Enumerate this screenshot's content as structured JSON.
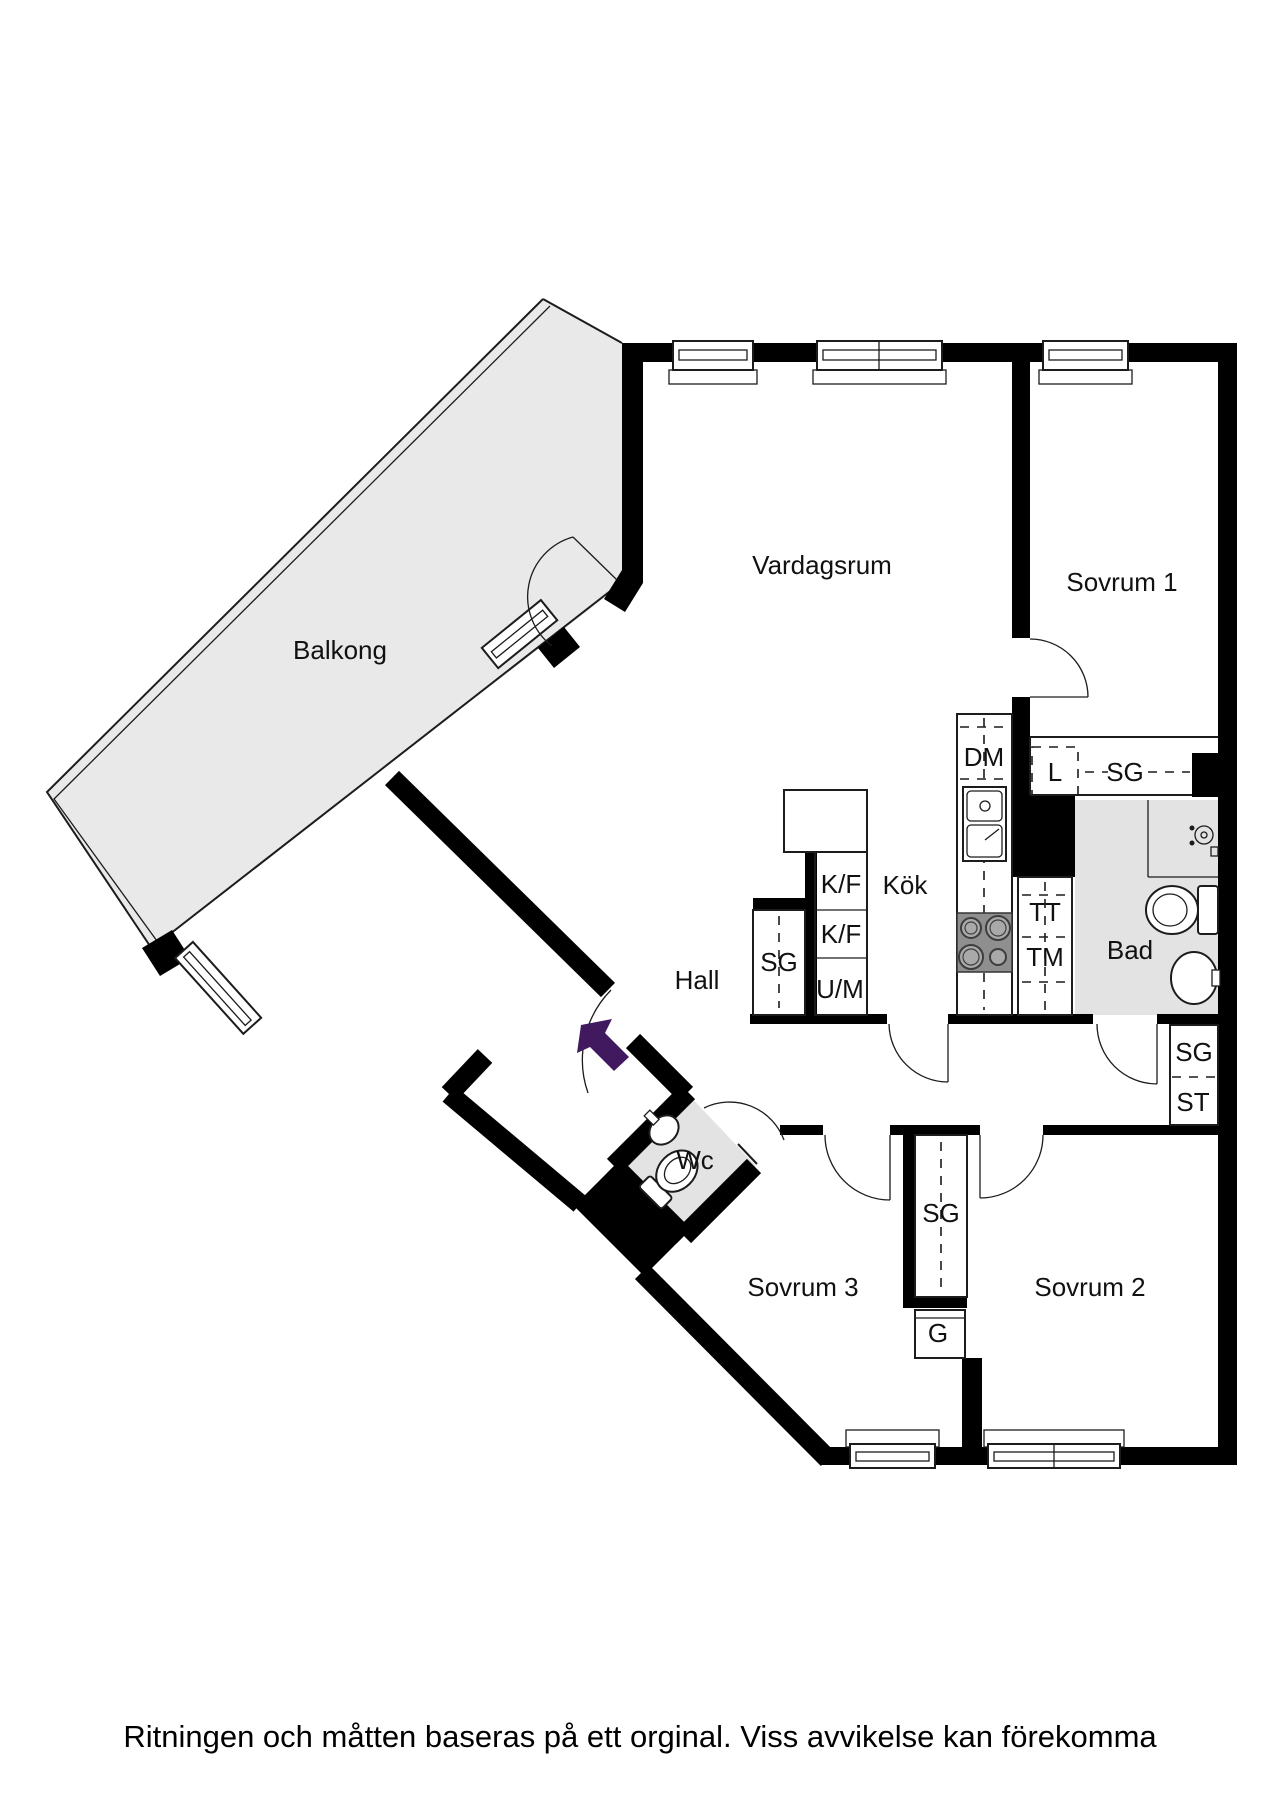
{
  "rooms": {
    "balcony": "Balkong",
    "living": "Vardagsrum",
    "bedroom1": "Sovrum 1",
    "kitchen": "Kök",
    "hall": "Hall",
    "bath": "Bad",
    "wc": "Wc",
    "bedroom3": "Sovrum 3",
    "bedroom2": "Sovrum 2"
  },
  "fixtures": {
    "dm": "DM",
    "l": "L",
    "sg_top": "SG",
    "tt": "TT",
    "tm": "TM",
    "sg_hall": "SG",
    "kf1": "K/F",
    "kf2": "K/F",
    "um": "U/M",
    "sg_corridor": "SG",
    "st": "ST",
    "sg_bedrooms": "SG",
    "g": "G"
  },
  "footer": {
    "disclaimer": "Ritningen och måtten baseras på ett orginal. Viss avvikelse kan förekomma"
  },
  "colors": {
    "wall": "#000000",
    "balcony_fill": "#e9e9e9",
    "wet_fill": "#e3e3e3",
    "arrow": "#41195f",
    "stove": "#8f8f8f"
  }
}
